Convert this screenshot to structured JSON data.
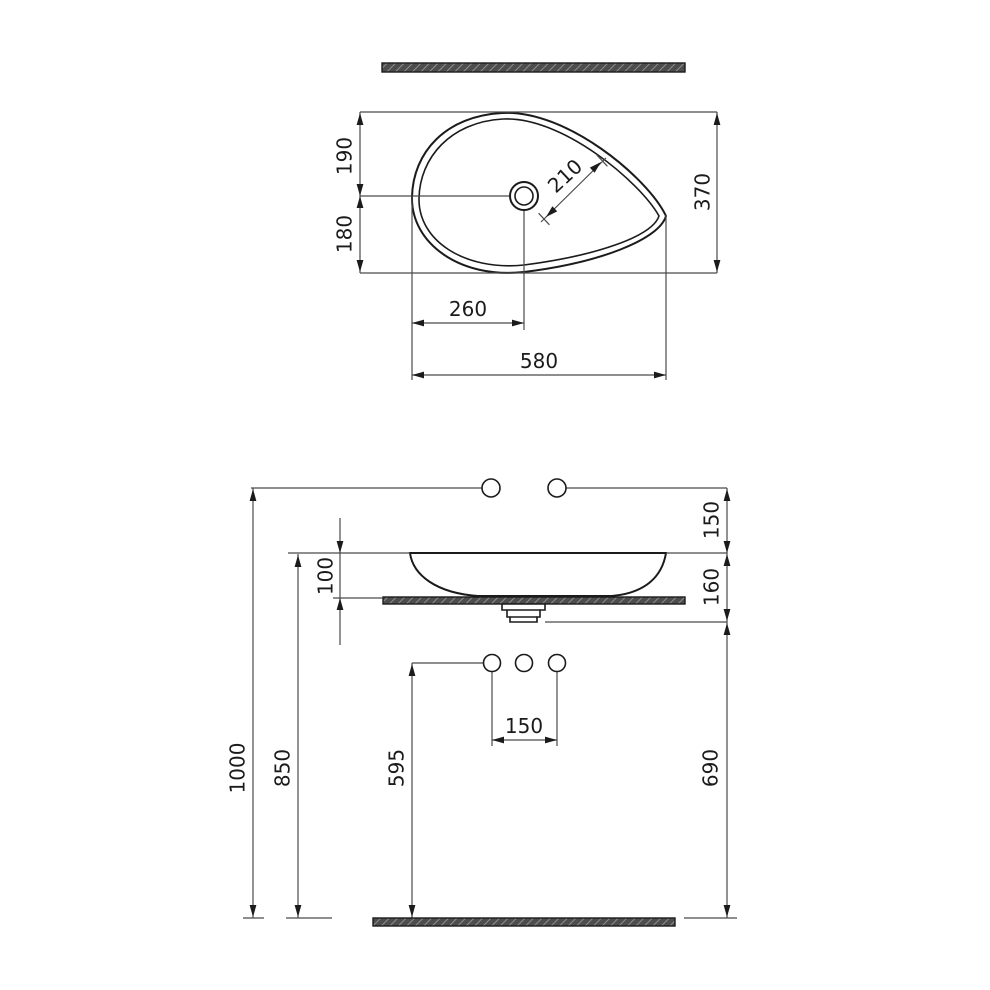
{
  "drawing": {
    "type": "washbasin installation technical drawing",
    "colors": {
      "outline": "#1b1b1b",
      "dimension_lines": "#4a4a4a",
      "hatch_dark": "#4d4d4d",
      "hatch_light": "#9e9e9e",
      "background": "#ffffff"
    },
    "top_view": {
      "offset_top": "190",
      "offset_bottom": "180",
      "depth_total": "370",
      "hole_diagonal": "210",
      "hole_from_left": "260",
      "width_total": "580"
    },
    "front_view": {
      "rim_to_wall_holes": "150",
      "bowl_height": "100",
      "rim_to_drain_line": "160",
      "wall_holes_height": "1000",
      "rim_height": "850",
      "deck_holes_height": "595",
      "hole_spacing": "150",
      "drain_line_height": "690"
    }
  }
}
